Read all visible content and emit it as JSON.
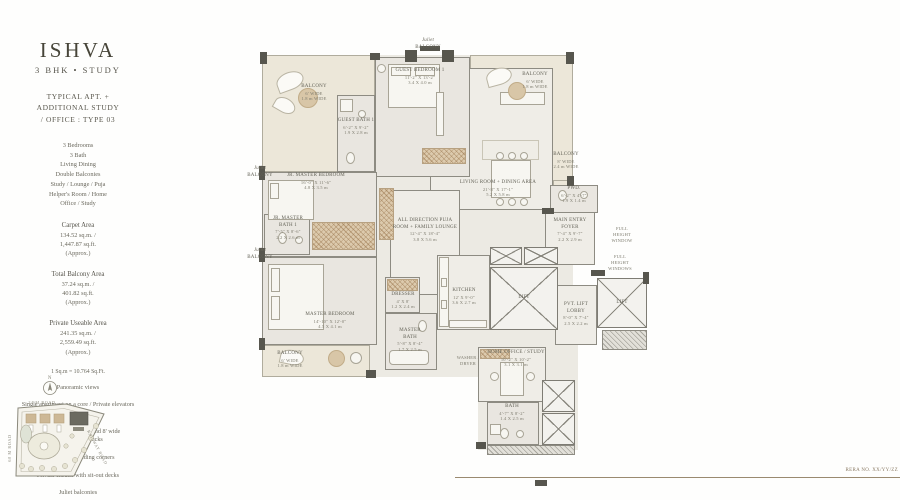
{
  "sidebar": {
    "brand": "ISHVA",
    "subtitle": "3 BHK  •  STUDY",
    "type_lines": [
      "TYPICAL APT. +",
      "ADDITIONAL STUDY",
      "/ OFFICE : TYPE 03"
    ],
    "features": [
      "3 Bedrooms",
      "3 Bath",
      "Living Dining",
      "Double Balconies",
      "Study / Lounge / Puja",
      "Helper's Room / Home",
      "Office / Study"
    ],
    "areas": [
      {
        "label": "Carpet Area",
        "v1": "134.52 sq.m. /",
        "v2": "1,447.87 sq.ft.",
        "note": "(Approx.)"
      },
      {
        "label": "Total Balcony Area",
        "v1": "37.24 sq.m. /",
        "v2": "401.82 sq.ft.",
        "note": "(Approx.)"
      },
      {
        "label": "Private Useable Area",
        "v1": "241.35 sq.m. /",
        "v2": "2,559.49 sq.ft.",
        "note": "(Approx.)"
      }
    ],
    "conversion": "1 Sq.m = 10.764 Sq.Ft.",
    "highlights": [
      "Panoramic views",
      "Single apartment on a core / Private elevators and lift lobby",
      "Extravagant balconies and 8' wide entertainment decks",
      "Column free building corners",
      "Private ensuite with sit-out decks",
      "Juliet balconies"
    ]
  },
  "site_plan": {
    "compass": "N",
    "road_top": "24 M ROAD",
    "road_left": "60 M ROAD",
    "road_right": "RAILWAY ROAD"
  },
  "plan": {
    "juliet_top": {
      "l1": "Juliet",
      "l2": "BALCONY"
    },
    "juliet_left1": {
      "l1": "Juliet",
      "l2": "BALCONY"
    },
    "juliet_left2": {
      "l1": "Juliet",
      "l2": "BALCONY"
    },
    "balcony_tl": {
      "name": "BALCONY",
      "d1": "6' WIDE",
      "d2": "1.8 m WIDE"
    },
    "balcony_tr": {
      "name": "BALCONY",
      "d1": "6' WIDE",
      "d2": "1.8 m WIDE"
    },
    "balcony_r": {
      "name": "BALCONY",
      "d1": "8' WIDE",
      "d2": "2.4 m WIDE"
    },
    "balcony_bl": {
      "name": "BALCONY",
      "d1": "6' WIDE",
      "d2": "1.8 m WIDE"
    },
    "guest_bedroom": {
      "name": "GUEST BEDROOM 1",
      "d1": "11'-2\" X 13'-2\"",
      "d2": "3.4 X 4.0 m"
    },
    "guest_bath": {
      "name": "GUEST BATH 1",
      "d1": "6'-2\" X 9'-2\"",
      "d2": "1.9 X 2.8 m"
    },
    "jr_master_bedroom": {
      "name": "JR. MASTER BEDROOM",
      "d1": "16'-0\" X 11'-6\"",
      "d2": "4.8 X 3.5 m"
    },
    "jr_master_bath": {
      "name": "JR. MASTER BATH 1",
      "d1": "7'-5\" X 8'-6\"",
      "d2": "2.2 X 2.6 m"
    },
    "master_bedroom": {
      "name": "MASTER BEDROOM",
      "d1": "14'-10\" X 12'-0\"",
      "d2": "4.5 X 4.1 m"
    },
    "living_dining": {
      "name": "LIVING ROOM  +  DINING AREA",
      "d1": "21'-8\" X 17'-1\"",
      "d2": "5.2 X 5.8 m"
    },
    "puja_lounge": {
      "name": "ALL DIRECTION PUJA ROOM + FAMILY LOUNGE",
      "d1": "12'-4\" X 18'-4\"",
      "d2": "3.8 X 5.6 m"
    },
    "dresser": {
      "name": "DRESSER",
      "d1": "4' X 8'",
      "d2": "1.2 X 2.4 m"
    },
    "master_bath": {
      "name": "MASTER BATH",
      "d1": "5'-8\" X 8'-4\"",
      "d2": "1.7 X 2.5 m"
    },
    "kitchen": {
      "name": "KITCHEN",
      "d1": "12' X 9'-0\"",
      "d2": "3.6 X 2.7 m"
    },
    "lift1": {
      "name": "LIFT"
    },
    "lift2": {
      "name": "LIFT"
    },
    "pvt_lobby": {
      "name": "PVT. LIFT LOBBY",
      "d1": "8'-0\" X 7'-4\"",
      "d2": "2.5 X 2.2 m"
    },
    "entry_foyer": {
      "name": "MAIN ENTRY FOYER",
      "d1": "7'-4\" X 9'-7\"",
      "d2": "2.2 X 2.9 m"
    },
    "pwd": {
      "name": "PWD.",
      "d1": "6'-2\" X 4'-7\"",
      "d2": "1.9 X 1.4 m"
    },
    "fhw1": {
      "l1": "FULL",
      "l2": "HEIGHT",
      "l3": "WINDOW"
    },
    "fhw2": {
      "l1": "FULL",
      "l2": "HEIGHT",
      "l3": "WINDOWS"
    },
    "home_office": {
      "name": "HOME OFFICE / STUDY",
      "d1": "10'-2\" X 10'-2\"",
      "d2": "3.1 X 3.1 m"
    },
    "bath3": {
      "name": "BATH",
      "d1": "4'-7\" X 8'-2\"",
      "d2": "1.4 X 2.5 m"
    },
    "laundry": {
      "l1": "WASHER /",
      "l2": "DRYER"
    },
    "rera": "RERA NO. XX/YY/ZZ"
  }
}
